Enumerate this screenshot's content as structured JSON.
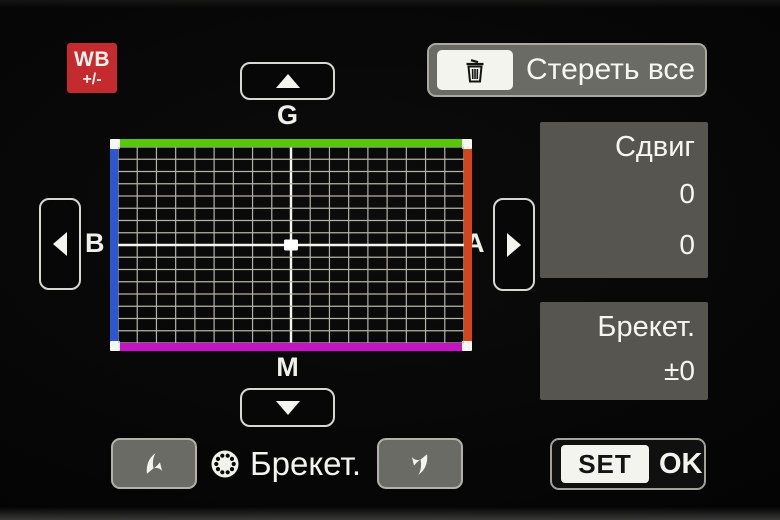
{
  "colors": {
    "accent_red": "#c42a2e",
    "grid_green": "#58c70c",
    "grid_blue": "#2f55cf",
    "grid_amber": "#d64419",
    "grid_magenta": "#c414c4",
    "panel_gray": "#57554f",
    "button_gray": "#6b6b65"
  },
  "header": {
    "wb_badge_line1": "WB",
    "wb_badge_line2": "+/-",
    "erase_all_label": "Стереть все"
  },
  "grid": {
    "axis_top": "G",
    "axis_bottom": "M",
    "axis_left": "B",
    "axis_right": "A",
    "columns": 18,
    "rows": 16,
    "marker": {
      "col_offset": 0,
      "row_offset": 0
    }
  },
  "shift_panel": {
    "title": "Сдвиг",
    "values": [
      "0",
      "0"
    ]
  },
  "bracket_panel": {
    "title": "Брекет.",
    "value": "±0"
  },
  "footer": {
    "bracket_label": "Брекет.",
    "set_label": "SET",
    "ok_label": "OK"
  }
}
